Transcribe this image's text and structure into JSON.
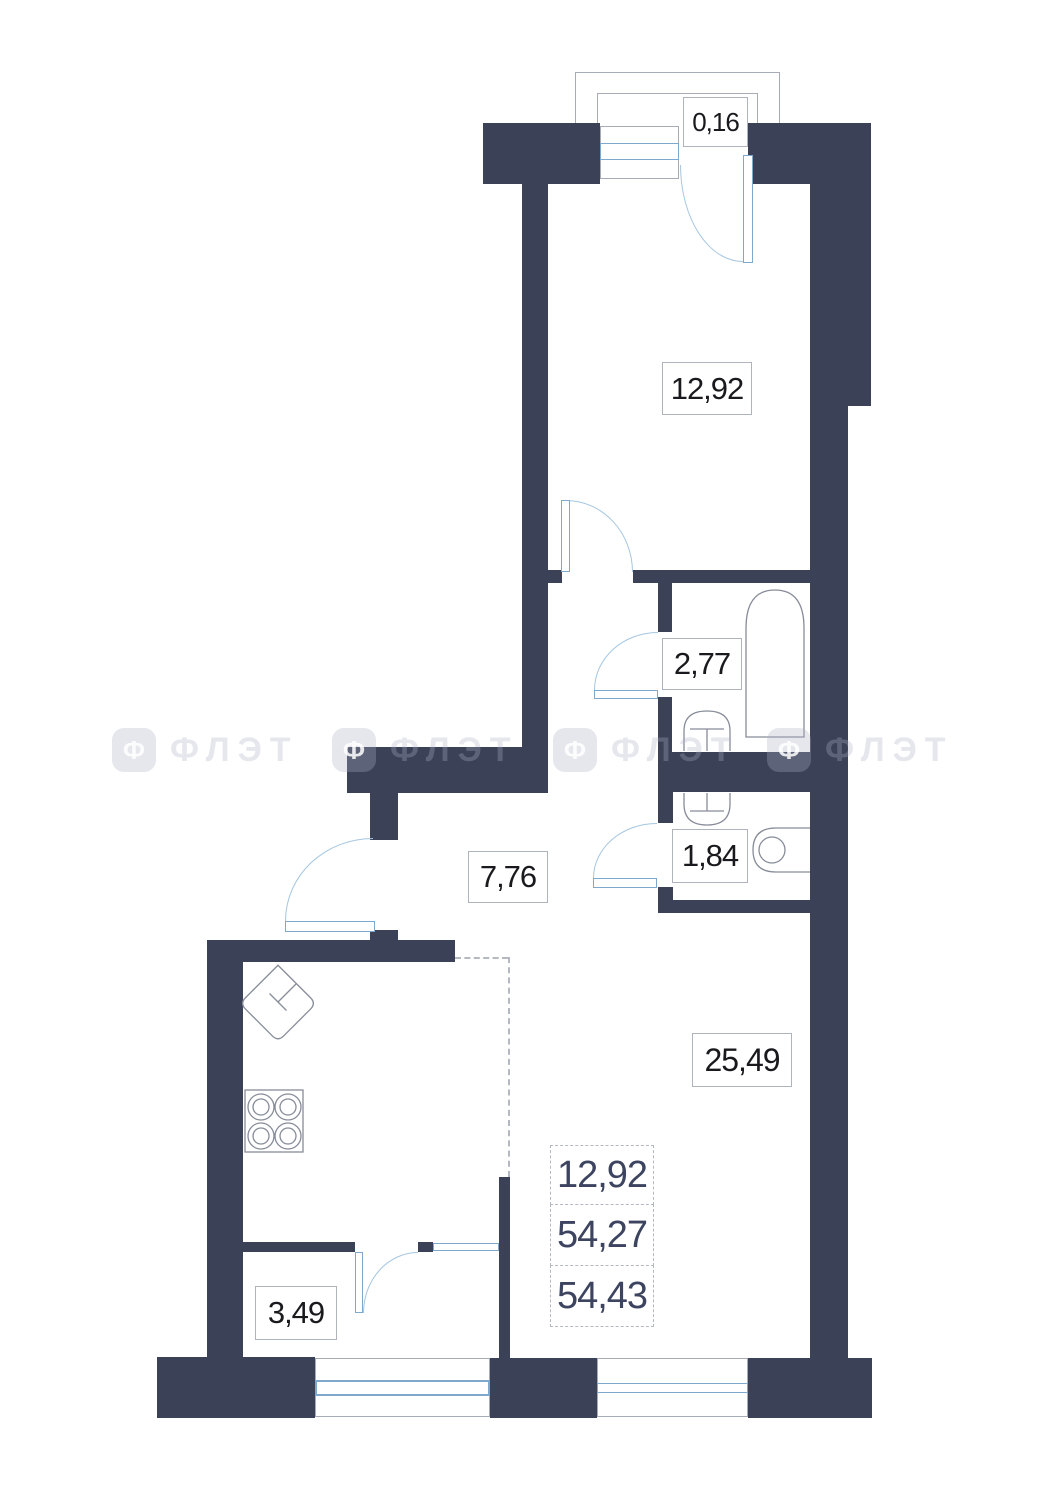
{
  "plan": {
    "rooms": [
      {
        "name": "balcony-top",
        "area": "0,16"
      },
      {
        "name": "bedroom",
        "area": "12,92"
      },
      {
        "name": "bathroom",
        "area": "2,77"
      },
      {
        "name": "hallway",
        "area": "7,76"
      },
      {
        "name": "wc",
        "area": "1,84"
      },
      {
        "name": "living-kitchen",
        "area": "25,49"
      },
      {
        "name": "loggia-bottom",
        "area": "3,49"
      }
    ],
    "area_summary": [
      "12,92",
      "54,27",
      "54,43"
    ],
    "watermark": {
      "logo_letter": "Ф",
      "text": "ФЛЭТ"
    },
    "colors": {
      "wall": "#3B4258",
      "window_frame": "#7FA8CD",
      "door_arc": "#A5C6E1",
      "fixture_outline": "#878C99",
      "label_border": "#AFB3BB",
      "label_text": "#1A1A1E",
      "summary_text": "#3D4460",
      "dashed_line": "#B4B8C0",
      "balcony_outline": "#A6ABB5"
    }
  }
}
